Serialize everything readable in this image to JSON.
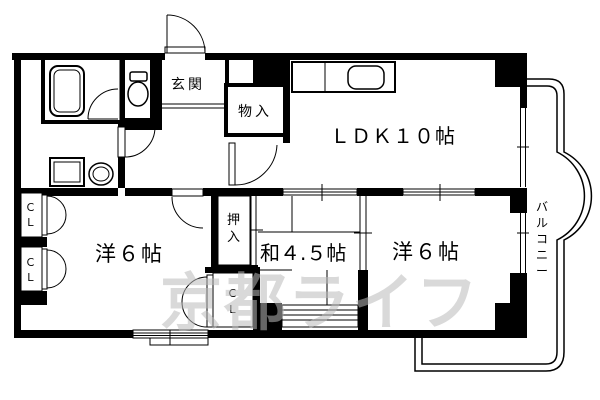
{
  "floorplan": {
    "labels": {
      "genkan": "玄関",
      "monoire": "物入",
      "ldk": "ＬＤＫ１０帖",
      "washitsu": "和４.５帖",
      "youshitsu_left": "洋６帖",
      "youshitsu_right": "洋６帖",
      "oshiire_chars": [
        "押",
        "入"
      ],
      "closet_chars": [
        "Ｃ",
        "Ｌ"
      ],
      "balcony_chars": [
        "バ",
        "ル",
        "コ",
        "ニ",
        "ー"
      ]
    },
    "watermark": "京都ライフ",
    "colors": {
      "line": "#000000",
      "background": "#ffffff",
      "watermark": "#b9b9b9"
    }
  }
}
